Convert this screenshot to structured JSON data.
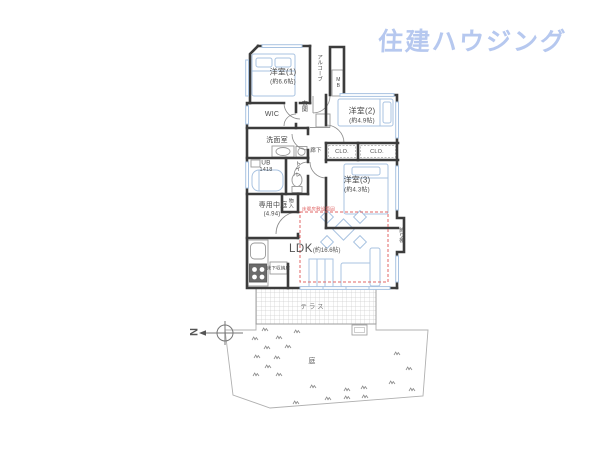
{
  "logo": {
    "text": "住建ハウジング"
  },
  "compass": {
    "north": "N"
  },
  "plan": {
    "bedroom1": {
      "name": "洋室(1)",
      "size": "(約6.6帖)"
    },
    "bedroom2": {
      "name": "洋室(2)",
      "size": "(約4.9帖)"
    },
    "bedroom3": {
      "name": "洋室(3)",
      "size": "(約4.3帖)"
    },
    "ldk": {
      "name": "LDK",
      "size": "(約16.6帖)"
    },
    "courtyard": {
      "name": "専用中庭",
      "size": "(4.94)"
    },
    "washroom": "洗面室",
    "bath": {
      "name": "UB",
      "size": "1418"
    },
    "toilet": "トイレ",
    "wic": "WIC",
    "entrance": "玄関",
    "alcove": "アルコーブ",
    "hallway": "廊下",
    "closet1": "CLO.",
    "closet2": "CLO.",
    "storage": "物入",
    "meter_box": "MB",
    "shelf": "飾り棚",
    "terrace": "テラス",
    "garden": "庭",
    "floor_heating_note": "床暖房敷設範囲",
    "underfloor_storage_note": "床下収納庫"
  },
  "colors": {
    "logo": "#b6c8ef",
    "wall": "#3c3c3c",
    "fixture": "#a9c3e1",
    "heating": "#e06666",
    "text": "#4a4a4a"
  }
}
